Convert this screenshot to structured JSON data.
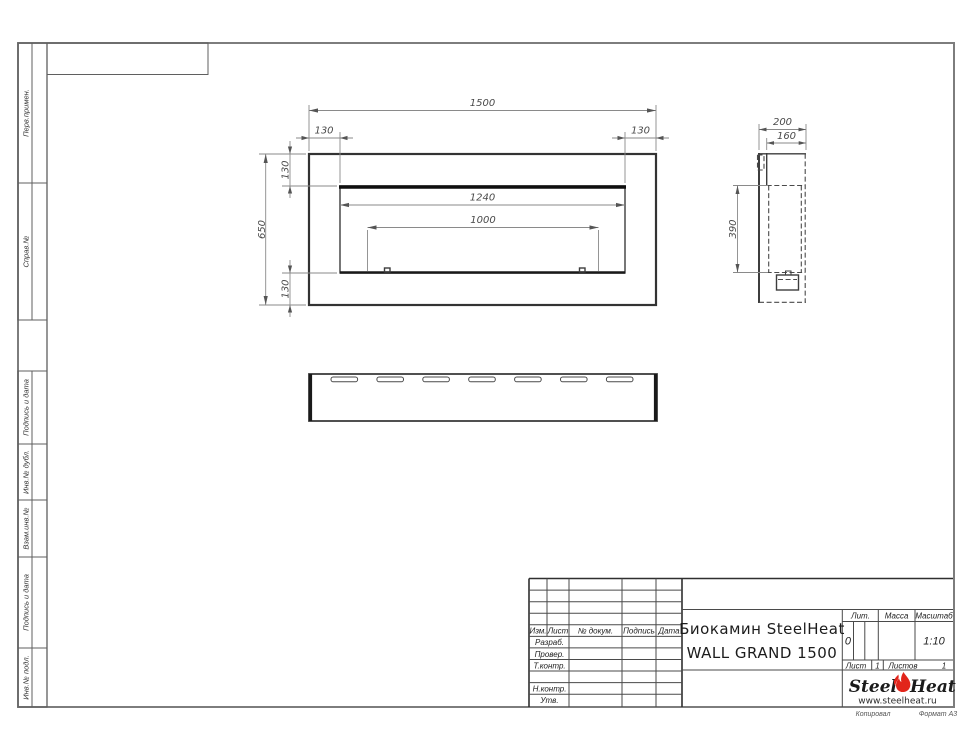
{
  "sheet": {
    "sidebar": {
      "items": [
        {
          "label": "Перв.примен."
        },
        {
          "label": "Справ.№"
        },
        {
          "label": "Подпись и дата"
        },
        {
          "label": "Инв.№ дубл."
        },
        {
          "label": "Взам.инв.№"
        },
        {
          "label": "Подпись и дата"
        },
        {
          "label": "Инв.№ подл."
        }
      ]
    },
    "footer": {
      "copied": "Копировал",
      "format": "Формат А3"
    }
  },
  "drawing": {
    "front_view": {
      "dim_width": "1500",
      "dim_left_offset": "130",
      "dim_right_offset": "130",
      "dim_top_offset": "130",
      "dim_height": "650",
      "dim_bottom_offset": "130",
      "dim_opening_width": "1240",
      "dim_burner_width": "1000"
    },
    "side_view": {
      "dim_depth": "200",
      "dim_body_depth": "160",
      "dim_opening_height": "390"
    },
    "bottom_view": {
      "slot_count": 7
    }
  },
  "title_block": {
    "revision_header": {
      "izm": "Изм.",
      "list": "Лист",
      "doc": "№ докум.",
      "sign": "Подпись",
      "date": "Дата"
    },
    "roles": {
      "developed": "Разраб.",
      "checked": "Провер.",
      "tcontrol": "Т.контр.",
      "ncontrol": "Н.контр.",
      "approved": "Утв."
    },
    "name_line1": "Биокамин SteelHeat",
    "name_line2": "WALL GRAND 1500",
    "lit_label": "Лит.",
    "mass_label": "Масса",
    "scale_label": "Масштаб",
    "lit_value": "0",
    "scale_value": "1:10",
    "sheet_label": "Лист",
    "sheet_value": "1",
    "sheets_label": "Листов",
    "sheets_value": "1",
    "logo": {
      "part1": "Steel",
      "part2": "Heat",
      "url": "www.steelheat.ru",
      "flame_color": "#e2251b"
    }
  }
}
